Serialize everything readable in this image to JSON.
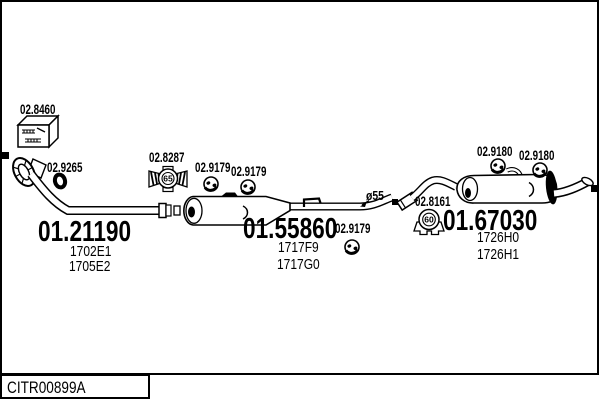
{
  "drawing": {
    "code": "CITR00899A",
    "diameter_note": "ø55"
  },
  "parts": {
    "gasket_kit": {
      "label": "02.8460"
    },
    "seal_ring": {
      "label": "02.9265"
    },
    "front_pipe": {
      "label": "01.21190",
      "refs": [
        "1702E1",
        "1705E2"
      ]
    },
    "clamp_centre": {
      "label": "02.8287",
      "diameter": "65"
    },
    "hanger_centre_1": {
      "label": "02.9179"
    },
    "hanger_centre_2": {
      "label": "02.9179"
    },
    "hanger_centre_3": {
      "label": "02.9179"
    },
    "centre_silencer": {
      "label": "01.55860",
      "refs": [
        "1717F9",
        "1717G0"
      ]
    },
    "clamp_rear": {
      "label": "02.8161",
      "diameter": "60"
    },
    "rear_silencer": {
      "label": "01.67030",
      "refs": [
        "1726H0",
        "1726H1"
      ]
    },
    "hanger_rear_1": {
      "label": "02.9180"
    },
    "hanger_rear_2": {
      "label": "02.9180"
    }
  }
}
